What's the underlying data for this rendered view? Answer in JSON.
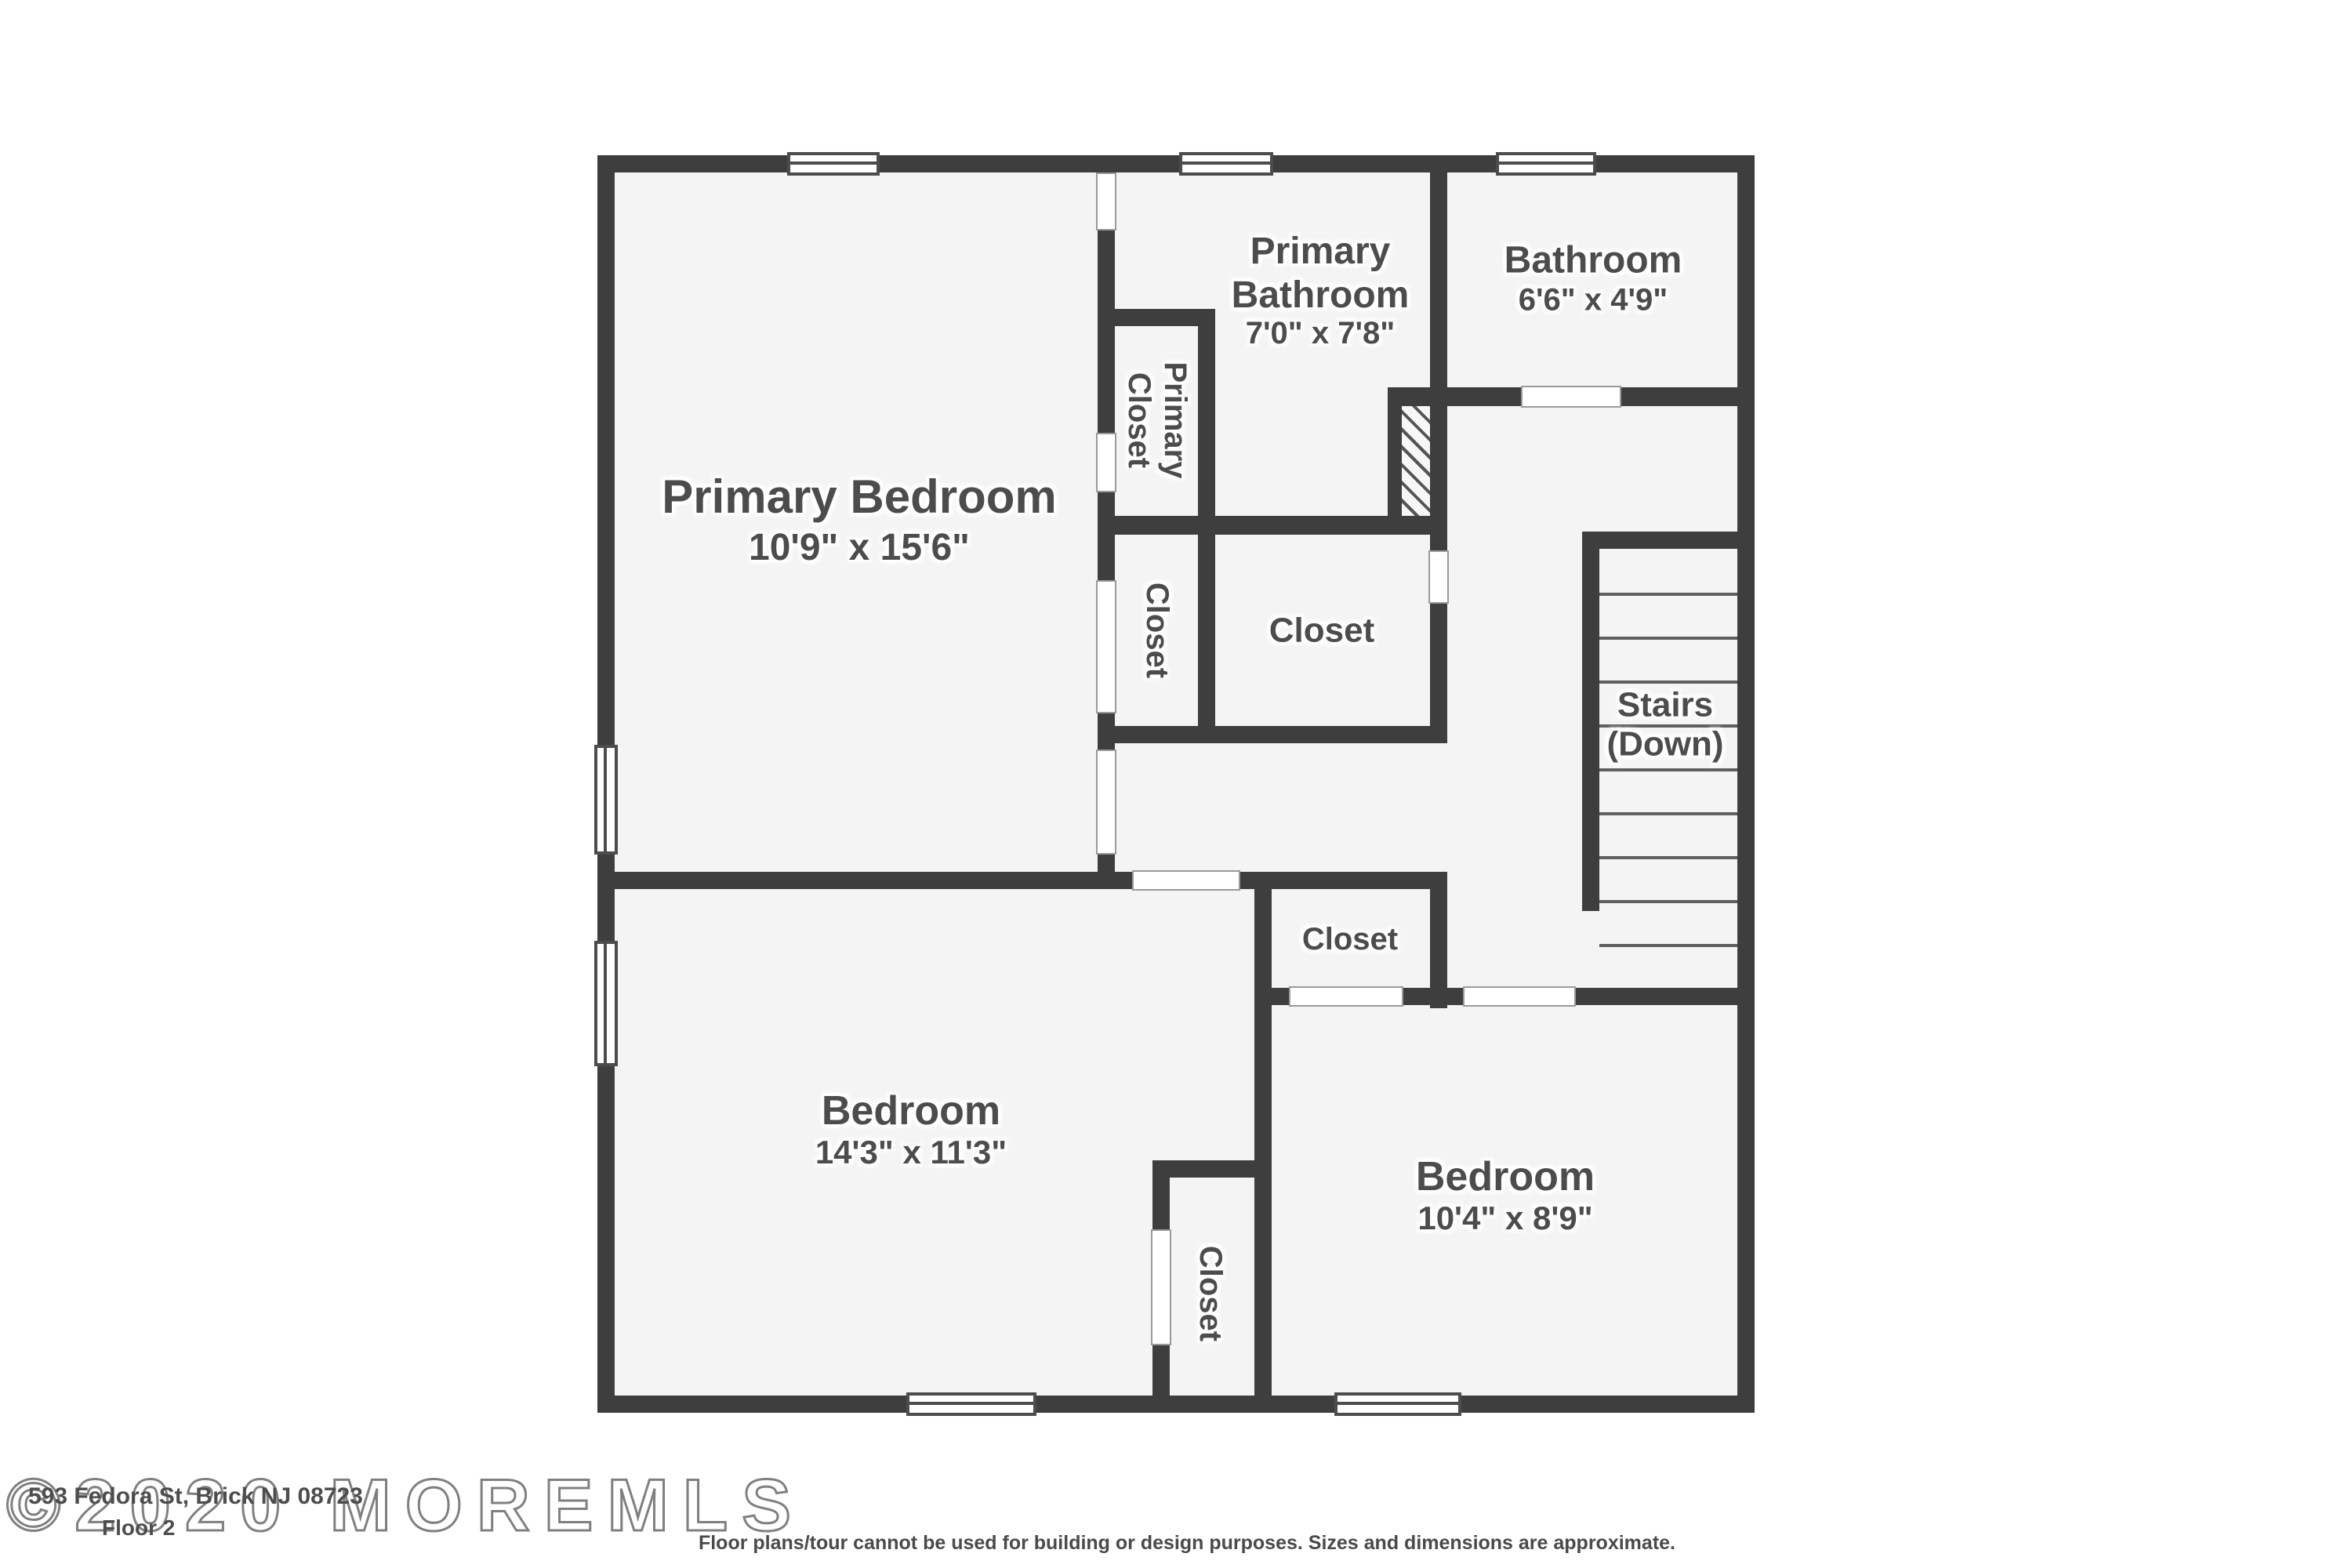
{
  "floor_plan": {
    "rooms": {
      "primary_bedroom": {
        "name": "Primary Bedroom",
        "dims": "10'9\" x 15'6\""
      },
      "primary_bathroom": {
        "name": "Primary Bathroom",
        "dims": "7'0\" x 7'8\""
      },
      "bathroom": {
        "name": "Bathroom",
        "dims": "6'6\" x 4'9\""
      },
      "primary_closet": {
        "name": "Primary Closet"
      },
      "closet_left_mid": {
        "name": "Closet"
      },
      "closet_center": {
        "name": "Closet"
      },
      "stairs": {
        "name": "Stairs",
        "direction": "(Down)"
      },
      "closet_hall": {
        "name": "Closet"
      },
      "bedroom_left": {
        "name": "Bedroom",
        "dims": "14'3\" x 11'3\""
      },
      "closet_lower": {
        "name": "Closet"
      },
      "bedroom_right": {
        "name": "Bedroom",
        "dims": "10'4\" x 8'9\""
      }
    },
    "footer": {
      "watermark": "©2020 MOREMLS",
      "address": "593 Fedora St, Brick NJ 08723",
      "floor_label": "Floor 2",
      "disclaimer": "Floor plans/tour cannot be used for building or design purposes. Sizes and dimensions are approximate."
    },
    "colors": {
      "wall": "#3e3e3e",
      "floor": "#f4f4f4",
      "text": "#4c4c4c"
    }
  }
}
